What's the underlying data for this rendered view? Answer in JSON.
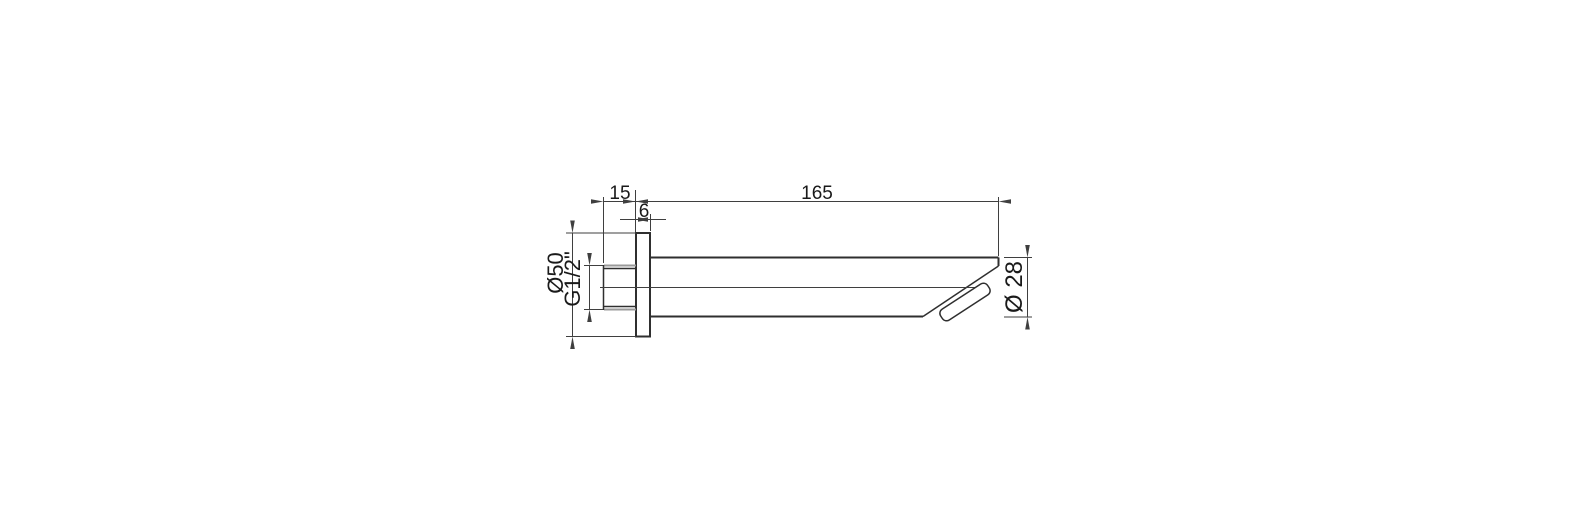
{
  "drawing": {
    "labels": {
      "nipple_length": "15",
      "flange_thickness": "6",
      "spout_length": "165",
      "flange_diameter": "Ø50",
      "thread_size": "G1/2\"",
      "spout_diameter": "Ø 28"
    }
  }
}
